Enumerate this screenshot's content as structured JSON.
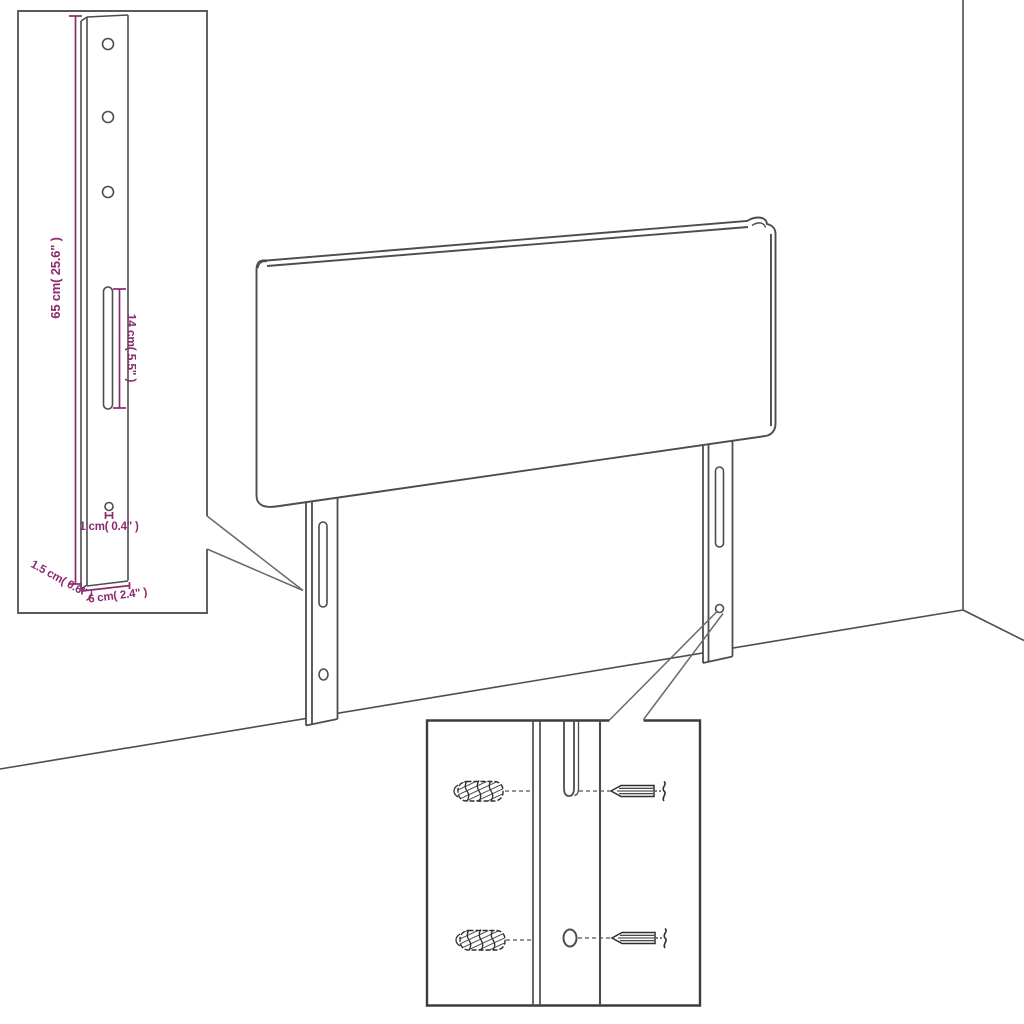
{
  "diagram": {
    "title": "Headboard with adjustable mounting legs - dimension and wall-fixing detail",
    "background": "#ffffff",
    "line_color": "#4d4d4d",
    "hardware_color": "#2f2f2f",
    "dimension_color": "#8b2a6e",
    "labels": {
      "leg_height": "65 cm( 25.6\" )",
      "slot_length": "14 cm( 5.5\" )",
      "hole_diameter": "1 cm( 0.4\" )",
      "leg_thickness": "1.5 cm( 0.6\" )",
      "leg_width": "6 cm( 2.4\" )"
    },
    "parts": {
      "detail_top_left": "mounting-leg-dimension-view",
      "main_view": "headboard-with-two-legs",
      "detail_bottom": "wall-plug-and-screw-fixing-view",
      "wall_plug_count": 2,
      "screw_count": 2
    }
  }
}
